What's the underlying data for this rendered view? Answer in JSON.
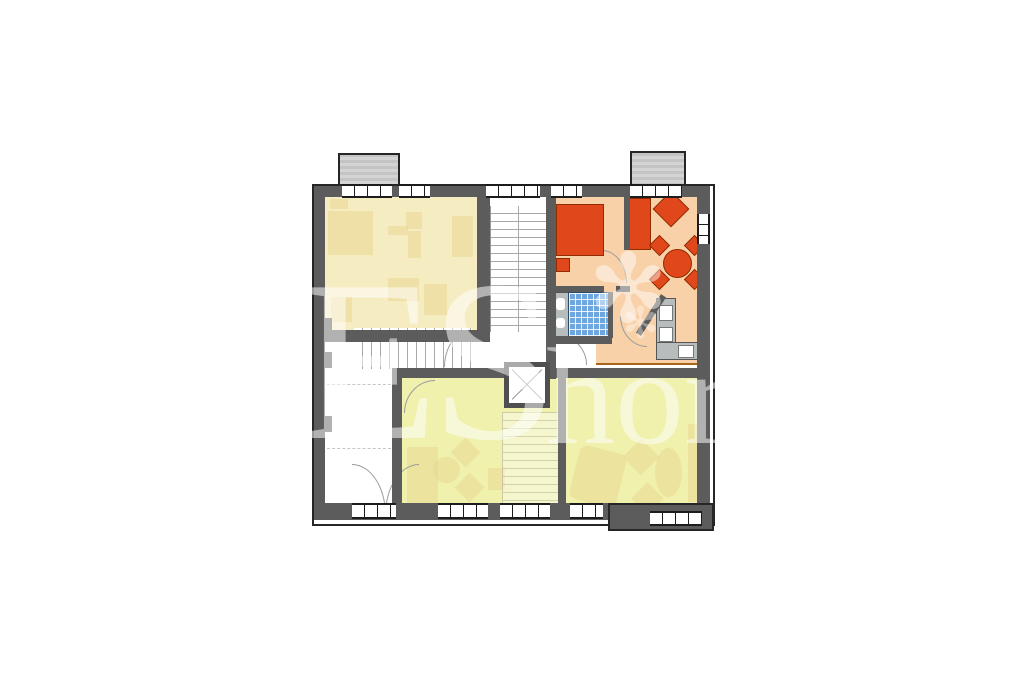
{
  "watermark": {
    "left_fragment": "ES",
    "right_fragment": "hor",
    "sparkle_glyph": "✻"
  },
  "colors": {
    "background": "#ffffff",
    "wall": "#5c5c5c",
    "chimney": "#c4c4c4",
    "room_yellow": "#f6ecc2",
    "room_yellow_border": "#47527b",
    "room_green": "#eff1ad",
    "room_green_border": "#64a52f",
    "room_orange": "#f8d1a8",
    "room_orange_border": "#a8651a",
    "furniture_orange": "#e0481b",
    "furniture_orange_border": "#8f2d00",
    "ghost_furniture": "#e7d792",
    "bath_tile": "#6ea7e0",
    "fixture_gray": "#b7bdbd",
    "watermark": "rgba(255,255,255,0.52)"
  },
  "plan": {
    "type": "residential floor plan",
    "areas": [
      {
        "name": "apartment-top-left",
        "fill": "room_yellow"
      },
      {
        "name": "apartment-top-right-highlighted",
        "fill": "room_orange"
      },
      {
        "name": "apartment-bottom",
        "fill": "room_green"
      },
      {
        "name": "stairwell-core",
        "fill": "white"
      },
      {
        "name": "entrance-hall",
        "fill": "white"
      }
    ],
    "features": [
      "staircase",
      "elevator",
      "entrance-double-door",
      "bathroom-blue-tiles",
      "kitchen-counter",
      "bed",
      "sofa",
      "armchair",
      "dining-table-with-chairs",
      "chimneys",
      "windows"
    ]
  }
}
